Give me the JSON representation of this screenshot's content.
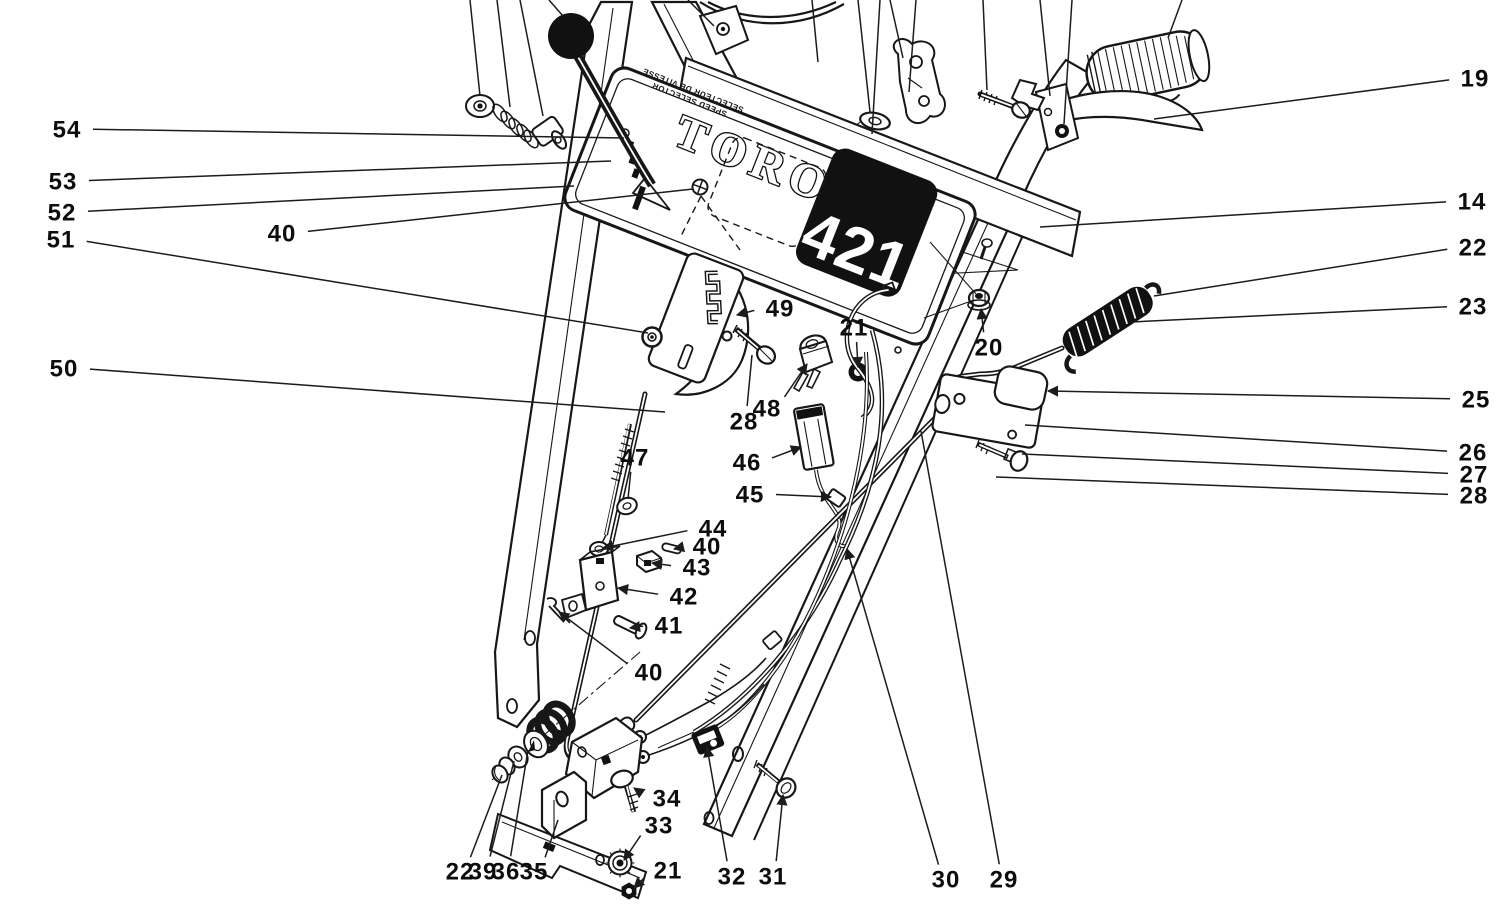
{
  "diagram": {
    "type": "exploded-parts-diagram",
    "subject": "Toro 421 snowthrower handle assembly parts diagram",
    "brand_logo": "TORO",
    "model_number": "421",
    "panel_caption_line1": "SPEED SELECTOR",
    "panel_caption_line2": "SELECTEUR DE VITESSE",
    "colors": {
      "ink": "#171717",
      "paper": "#ffffff"
    },
    "callouts": [
      {
        "label": "54",
        "x": 67,
        "y": 129,
        "tx": 624,
        "ty": 138,
        "arrow": false
      },
      {
        "label": "53",
        "x": 63,
        "y": 181,
        "tx": 611,
        "ty": 161,
        "arrow": false
      },
      {
        "label": "52",
        "x": 62,
        "y": 212,
        "tx": 574,
        "ty": 186,
        "arrow": false
      },
      {
        "label": "51",
        "x": 61,
        "y": 239,
        "tx": 648,
        "ty": 333,
        "arrow": false
      },
      {
        "label": "40",
        "x": 282,
        "y": 233,
        "tx": 693,
        "ty": 189,
        "arrow": false
      },
      {
        "label": "50",
        "x": 64,
        "y": 368,
        "tx": 665,
        "ty": 412,
        "arrow": false
      },
      {
        "label": "19",
        "x": 1475,
        "y": 78,
        "tx": 1154,
        "ty": 119,
        "arrow": false
      },
      {
        "label": "14",
        "x": 1472,
        "y": 201,
        "tx": 1040,
        "ty": 227,
        "arrow": false
      },
      {
        "label": "22",
        "x": 1473,
        "y": 247,
        "tx": 1154,
        "ty": 296,
        "arrow": false
      },
      {
        "label": "23",
        "x": 1473,
        "y": 306,
        "tx": 1131,
        "ty": 322,
        "arrow": false
      },
      {
        "label": "25",
        "x": 1476,
        "y": 399,
        "tx": 1048,
        "ty": 391,
        "arrow": true
      },
      {
        "label": "26",
        "x": 1473,
        "y": 452,
        "tx": 1025,
        "ty": 425,
        "arrow": false
      },
      {
        "label": "27",
        "x": 1474,
        "y": 474,
        "tx": 1022,
        "ty": 454,
        "arrow": false
      },
      {
        "label": "28",
        "x": 1474,
        "y": 495,
        "tx": 996,
        "ty": 477,
        "arrow": false
      },
      {
        "label": "49",
        "x": 780,
        "y": 308,
        "tx": 737,
        "ty": 315,
        "arrow": true
      },
      {
        "label": "21",
        "x": 854,
        "y": 327,
        "tx": 858,
        "ty": 367,
        "arrow": true
      },
      {
        "label": "20",
        "x": 989,
        "y": 347,
        "tx": 981,
        "ty": 309,
        "arrow": true
      },
      {
        "label": "48",
        "x": 767,
        "y": 408,
        "tx": 807,
        "ty": 364,
        "arrow": true
      },
      {
        "label": "28",
        "x": 744,
        "y": 421,
        "tx": 752,
        "ty": 355,
        "arrow": false
      },
      {
        "label": "46",
        "x": 747,
        "y": 462,
        "tx": 801,
        "ty": 447,
        "arrow": true
      },
      {
        "label": "45",
        "x": 750,
        "y": 494,
        "tx": 831,
        "ty": 497,
        "arrow": true
      },
      {
        "label": "47",
        "x": 635,
        "y": 457,
        "tx": 628,
        "ty": 499,
        "arrow": false
      },
      {
        "label": "44",
        "x": 713,
        "y": 528,
        "tx": 603,
        "ty": 548,
        "arrow": true
      },
      {
        "label": "40",
        "x": 707,
        "y": 546,
        "tx": 674,
        "ty": 549,
        "arrow": true
      },
      {
        "label": "43",
        "x": 697,
        "y": 567,
        "tx": 652,
        "ty": 563,
        "arrow": true
      },
      {
        "label": "42",
        "x": 684,
        "y": 596,
        "tx": 618,
        "ty": 588,
        "arrow": true
      },
      {
        "label": "41",
        "x": 669,
        "y": 625,
        "tx": 630,
        "ty": 628,
        "arrow": true
      },
      {
        "label": "40",
        "x": 649,
        "y": 672,
        "tx": 559,
        "ty": 612,
        "arrow": true
      },
      {
        "label": "34",
        "x": 667,
        "y": 798,
        "tx": 634,
        "ty": 788,
        "arrow": true
      },
      {
        "label": "33",
        "x": 659,
        "y": 825,
        "tx": 624,
        "ty": 860,
        "arrow": true
      },
      {
        "label": "21",
        "x": 668,
        "y": 870,
        "tx": 634,
        "ty": 888,
        "arrow": true
      },
      {
        "label": "22",
        "x": 460,
        "y": 871,
        "tx": 502,
        "ty": 775,
        "arrow": false
      },
      {
        "label": "39",
        "x": 483,
        "y": 871,
        "tx": 514,
        "ty": 761,
        "arrow": false
      },
      {
        "label": "36",
        "x": 506,
        "y": 871,
        "tx": 528,
        "ty": 750,
        "arrow": false
      },
      {
        "label": "35",
        "x": 534,
        "y": 871,
        "tx": 558,
        "ty": 820,
        "arrow": false
      },
      {
        "label": "32",
        "x": 732,
        "y": 876,
        "tx": 707,
        "ty": 747,
        "arrow": true
      },
      {
        "label": "31",
        "x": 773,
        "y": 876,
        "tx": 783,
        "ty": 795,
        "arrow": true
      },
      {
        "label": "30",
        "x": 946,
        "y": 879,
        "tx": 847,
        "ty": 549,
        "arrow": true
      },
      {
        "label": "29",
        "x": 1004,
        "y": 879,
        "tx": 921,
        "ty": 431,
        "arrow": false
      }
    ],
    "top_leader_lines": [
      {
        "x1": 470,
        "y1": 0,
        "x2": 480,
        "y2": 96
      },
      {
        "x1": 497,
        "y1": 0,
        "x2": 510,
        "y2": 107
      },
      {
        "x1": 520,
        "y1": 0,
        "x2": 543,
        "y2": 116
      },
      {
        "x1": 549,
        "y1": 0,
        "x2": 563,
        "y2": 16
      },
      {
        "x1": 688,
        "y1": 0,
        "x2": 714,
        "y2": 26
      },
      {
        "x1": 812,
        "y1": 0,
        "x2": 818,
        "y2": 62
      },
      {
        "x1": 858,
        "y1": 0,
        "x2": 870,
        "y2": 112
      },
      {
        "x1": 880,
        "y1": 0,
        "x2": 872,
        "y2": 134
      },
      {
        "x1": 890,
        "y1": 0,
        "x2": 903,
        "y2": 58
      },
      {
        "x1": 916,
        "y1": 0,
        "x2": 909,
        "y2": 92
      },
      {
        "x1": 983,
        "y1": 0,
        "x2": 987,
        "y2": 90
      },
      {
        "x1": 1040,
        "y1": 0,
        "x2": 1050,
        "y2": 96
      },
      {
        "x1": 1072,
        "y1": 0,
        "x2": 1064,
        "y2": 124
      },
      {
        "x1": 1182,
        "y1": 0,
        "x2": 1168,
        "y2": 38
      }
    ]
  }
}
